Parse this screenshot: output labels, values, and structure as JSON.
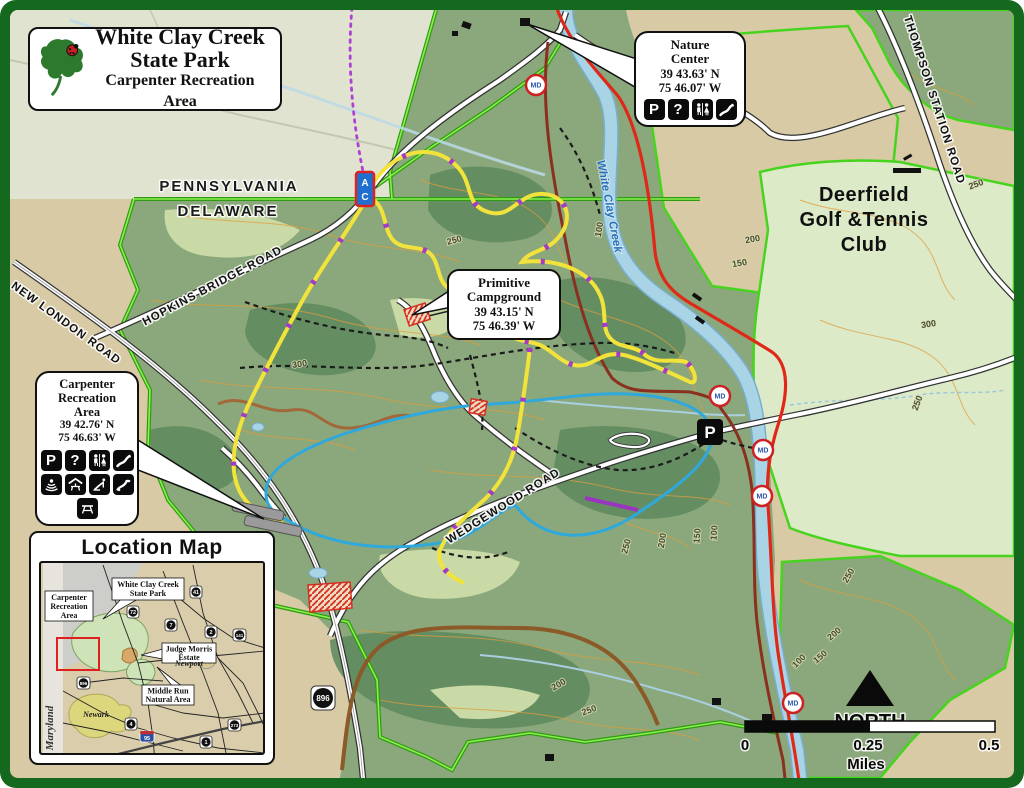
{
  "title_box": {
    "line1": "White Clay Creek",
    "line2": "State Park",
    "line3": "Carpenter Recreation Area"
  },
  "callouts": {
    "nature_center": {
      "line1": "Nature",
      "line2": "Center",
      "lat": "39 43.63' N",
      "lon": "75 46.07' W",
      "icons": [
        "parking",
        "information",
        "restrooms",
        "trailhead"
      ]
    },
    "primitive_campground": {
      "line1": "Primitive",
      "line2": "Campground",
      "lat": "39 43.15' N",
      "lon": "75 46.39' W"
    },
    "carpenter": {
      "line1": "Carpenter",
      "line2": "Recreation",
      "line3": "Area",
      "lat": "39 42.76' N",
      "lon": "75 46.63' W",
      "icons": [
        "parking",
        "information",
        "restrooms",
        "trailhead",
        "amphitheater",
        "pavilion",
        "playground",
        "disc-golf",
        "picnic-area"
      ]
    }
  },
  "icon_glyphs": {
    "parking": "P",
    "information": "?"
  },
  "labels": {
    "pennsylvania": "PENNSYLVANIA",
    "delaware": "DELAWARE",
    "new_london_road": "NEW LONDON ROAD",
    "hopkins_bridge_road": "HOPKINS BRIDGE ROAD",
    "wedgewood_road": "WEDGEWOOD ROAD",
    "thompson_station_road": "THOMPSON STATION ROAD",
    "creek": "White Clay Creek",
    "deerfield1": "Deerfield",
    "deerfield2": "Golf &Tennis",
    "deerfield3": "Club"
  },
  "markers": {
    "md": "MD",
    "marker_a": "A",
    "marker_c": "C",
    "parking": "P",
    "route_896": "896"
  },
  "contours": {
    "c100": "100",
    "c150": "150",
    "c200": "200",
    "c250": "250",
    "c300": "300"
  },
  "compass": {
    "north": "NORTH"
  },
  "scale_bar": {
    "zero": "0",
    "quarter": "0.25",
    "half": "0.5",
    "unit": "Miles"
  },
  "location_map": {
    "title": "Location Map",
    "maryland": "Maryland",
    "newark": "Newark",
    "newport": "Newport",
    "carpenter1": "Carpenter",
    "carpenter2": "Recreation",
    "carpenter3": "Area",
    "wccsp1": "White Clay Creek",
    "wccsp2": "State Park",
    "judge1": "Judge Morris",
    "judge2": "Estate",
    "middle1": "Middle Run",
    "middle2": "Natural Area",
    "shields": {
      "s41": "41",
      "s72": "72",
      "s7": "7",
      "s2": "2",
      "s141": "141",
      "s896": "896",
      "s4": "4",
      "s273": "273",
      "s1": "1",
      "i95": "95"
    }
  },
  "colors": {
    "frame": "#15691e",
    "boundary": "#46d41e",
    "water": "#a9d4e6",
    "trail_yellow": "#f2e33c",
    "trail_blue": "#2fa8dc",
    "blaze_purple": "#a23bc8",
    "road_red": "#e02818",
    "road_maroon": "#8a3020"
  }
}
